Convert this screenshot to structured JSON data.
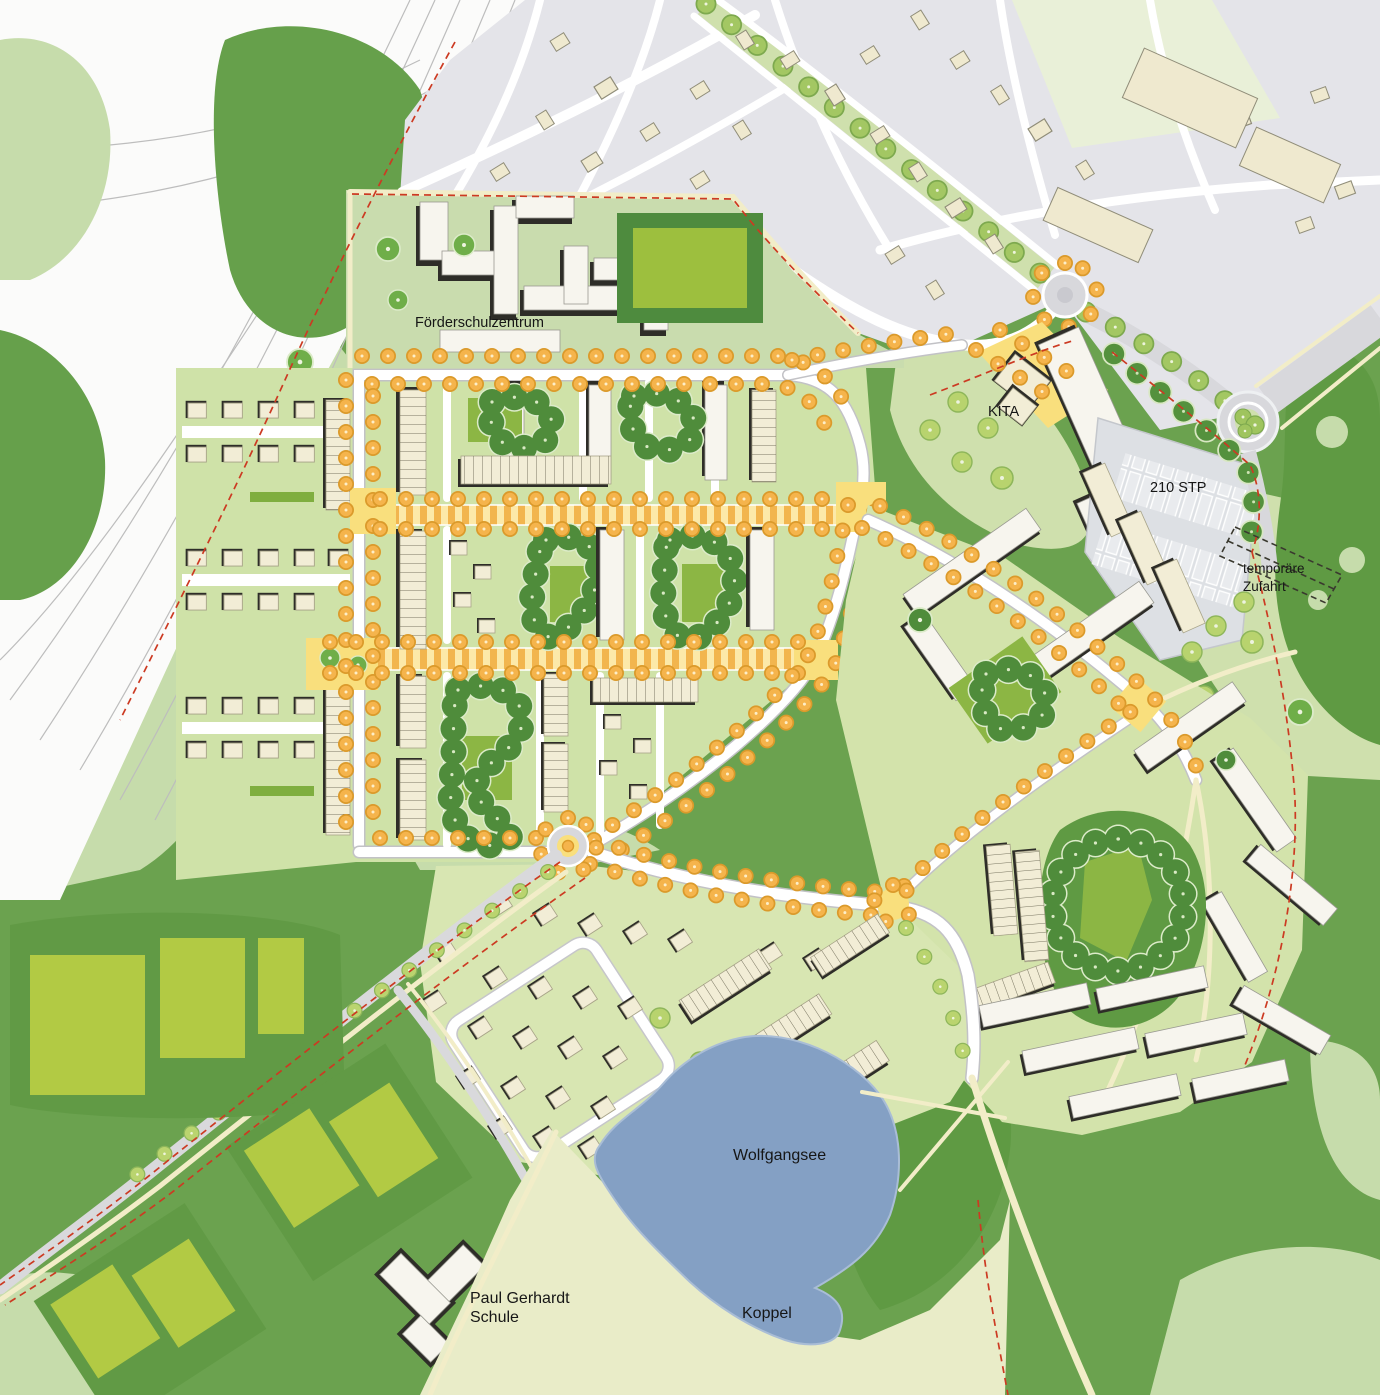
{
  "labels": {
    "foerderschulzentrum": "Förderschulzentrum",
    "kita": "KITA",
    "parking_stp": "210 STP",
    "temp_access_line1": "temporäre",
    "temp_access_line2": "Zufahrt",
    "lake": "Wolfgangsee",
    "meadow": "Koppel",
    "school_line1": "Paul Gerhardt",
    "school_line2": "Schule"
  },
  "colors": {
    "base_green": "#6ba24f",
    "light_green": "#c6dcab",
    "parcel_green": "#cfe2a8",
    "lawn_green": "#8cb644",
    "forest_green": "#5f9a43",
    "lake": "#84a0c4",
    "meadow": "#e9ecc8",
    "plaza_yellow": "#f9df7d",
    "street_tree_orange": "#f5b44c",
    "avenue_tree_green": "#a3c763",
    "building_new": "#f2edd6",
    "building_existing": "#efe9cf",
    "existing_town_grey": "#e4e4e9",
    "road_white": "#ffffff",
    "boundary_red": "#cc3a22"
  }
}
